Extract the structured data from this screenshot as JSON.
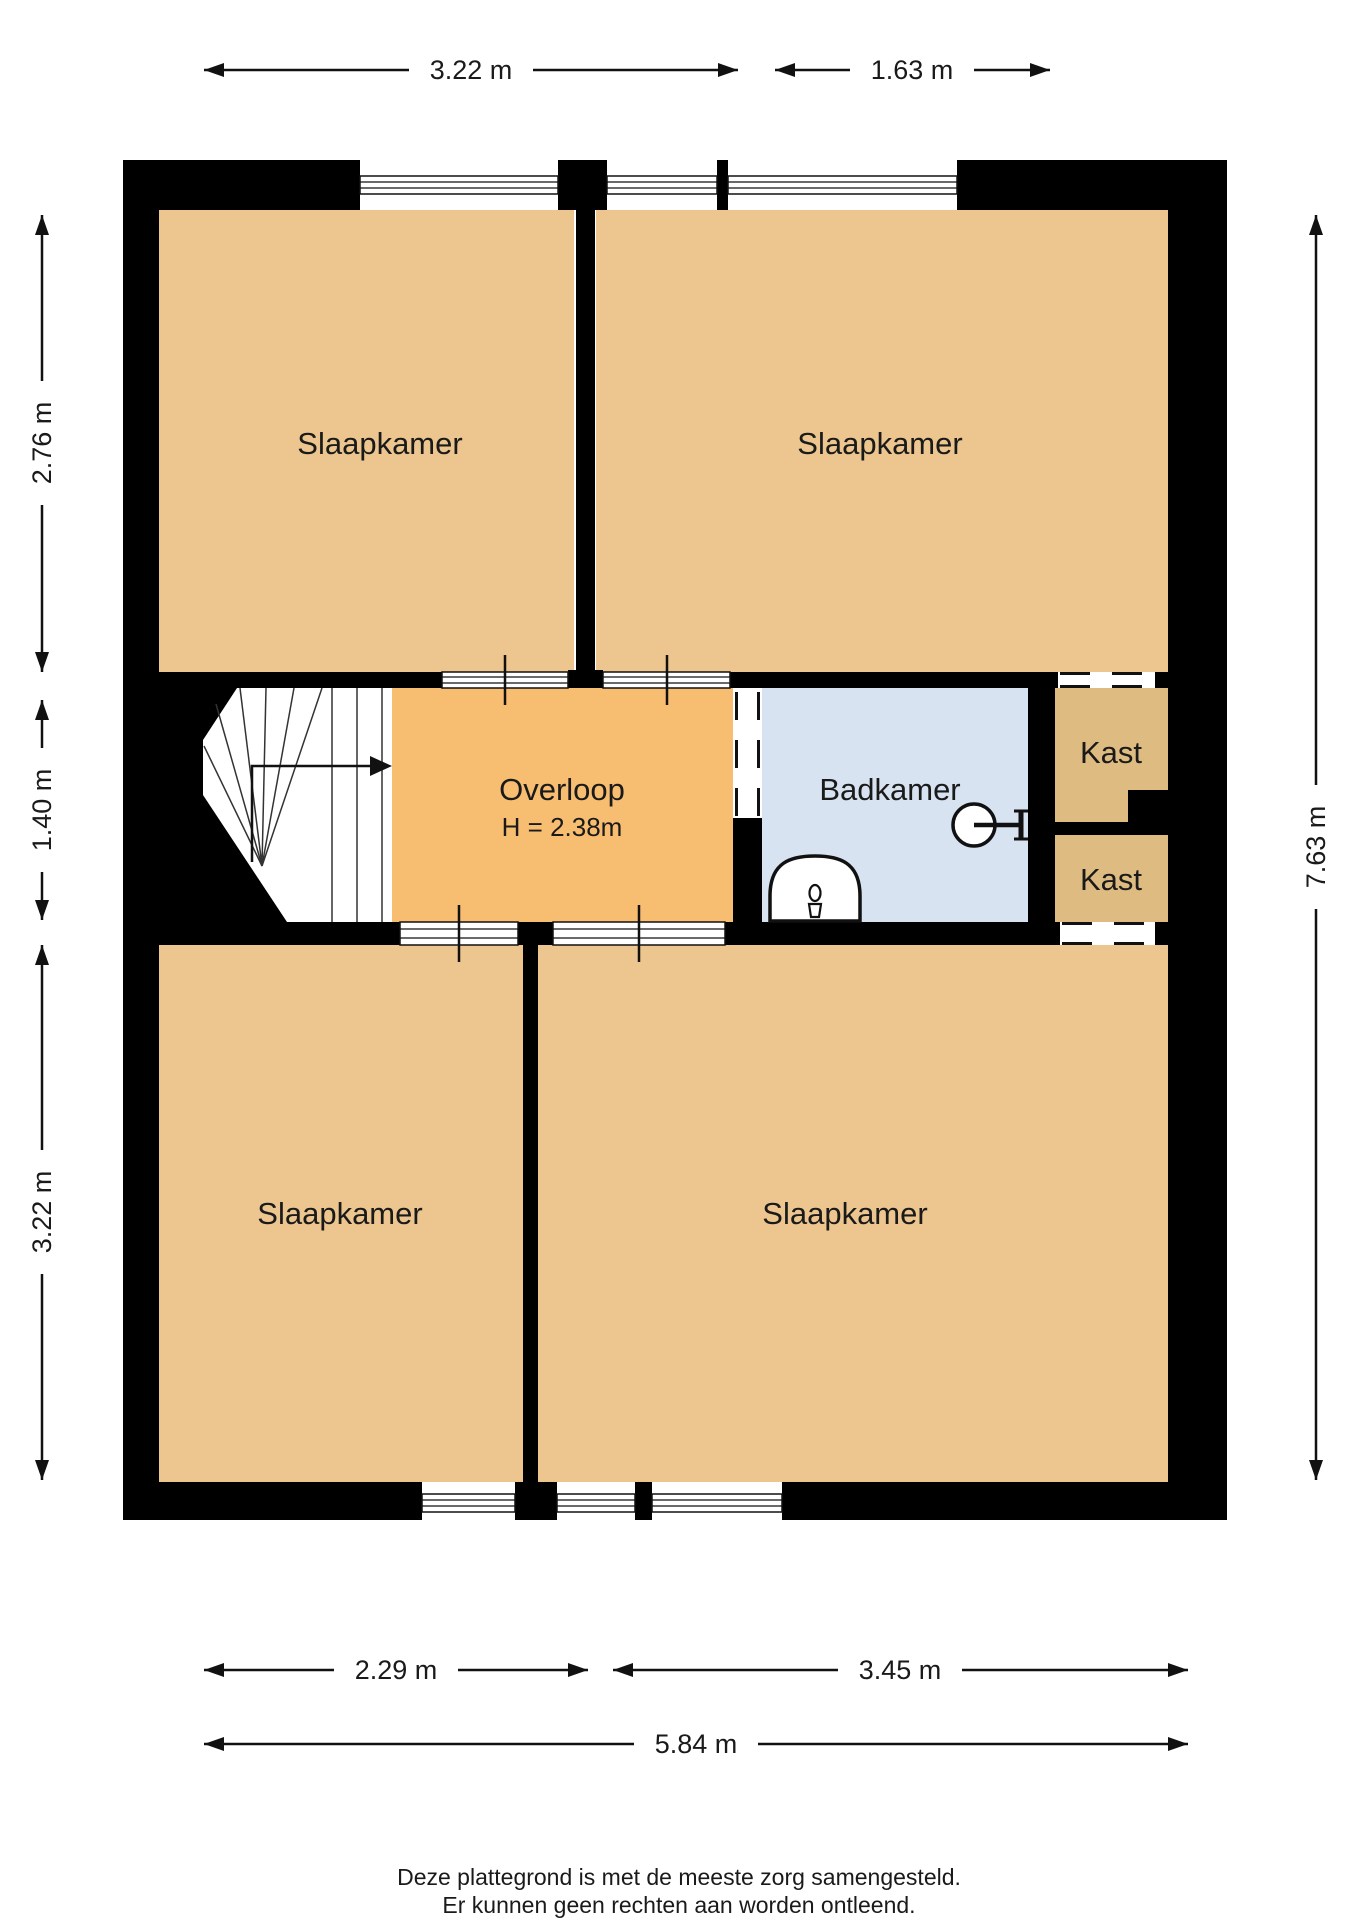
{
  "plan_title": "Plattegrond verdieping",
  "rooms": {
    "slaapkamer_tl": {
      "label": "Slaapkamer"
    },
    "slaapkamer_tr": {
      "label": "Slaapkamer"
    },
    "slaapkamer_bl": {
      "label": "Slaapkamer"
    },
    "slaapkamer_br": {
      "label": "Slaapkamer"
    },
    "overloop": {
      "label": "Overloop",
      "height_note": "H = 2.38m"
    },
    "badkamer": {
      "label": "Badkamer"
    },
    "kast_upper": {
      "label": "Kast"
    },
    "kast_lower": {
      "label": "Kast"
    }
  },
  "dimensions": {
    "top": [
      "3.22 m",
      "1.63 m"
    ],
    "left": [
      "2.76 m",
      "1.40 m",
      "3.22 m"
    ],
    "right": [
      "7.63 m"
    ],
    "bottom": [
      "2.29 m",
      "3.45 m",
      "5.84 m"
    ]
  },
  "fixtures": [
    "toilet-icon",
    "sink-icon",
    "staircase",
    "stair-direction-arrow"
  ],
  "footer": {
    "line1": "Deze plattegrond is met de meeste zorg samengesteld.",
    "line2": "Er kunnen geen rechten aan worden ontleend."
  },
  "colors": {
    "bedroom": "#ecc68e",
    "hallway": "#f7bd71",
    "bathroom": "#d7e3f0",
    "closet": "#debb80",
    "wall": "#000000",
    "background": "#ffffff"
  }
}
